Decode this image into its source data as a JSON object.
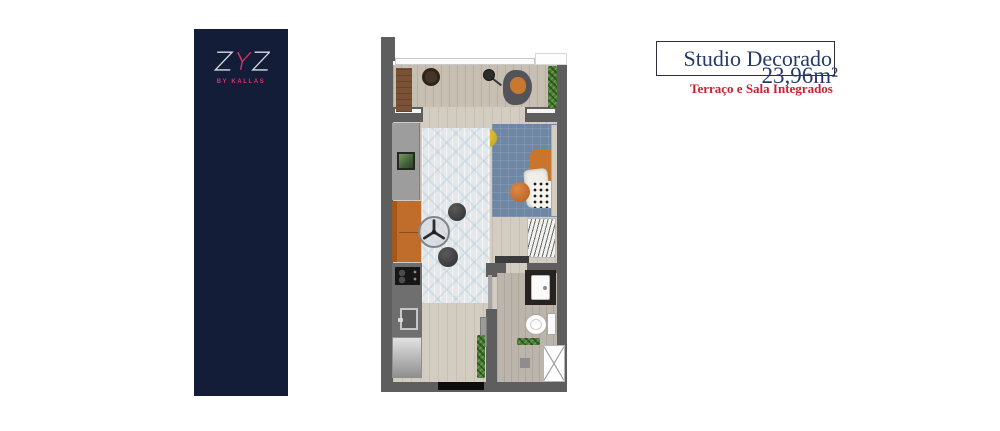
{
  "banner": {
    "logo_text": "ZYZ",
    "tagline": "BY KALLAS",
    "bg_color": "#131d38",
    "accent_pink": "#d8336b",
    "letter_silver": "#d9dde6"
  },
  "header": {
    "title": "Studio Decorado",
    "area": "23,96m²",
    "subtitle": "Terraço e Sala Integrados",
    "title_color": "#26396a",
    "subtitle_color": "#cc2030"
  },
  "floor_plan": {
    "label": "studio-floor-plan",
    "furniture_icons": [
      "terrace-rug-icon",
      "terrace-coffee-table-icon",
      "floor-lamp-icon",
      "terrace-armchair-icon",
      "planter-icon",
      "bed-icon",
      "bed-pillows-icon",
      "yellow-pouf-icon",
      "area-rug-icon",
      "tv-console-icon",
      "tv-icon",
      "sofa-icon",
      "round-dining-table-icon",
      "stool-icon",
      "stool-icon",
      "kitchen-counter-icon",
      "cooktop-icon",
      "kitchen-sink-icon",
      "refrigerator-icon",
      "wardrobe-icon",
      "dresser-icon",
      "bathroom-vanity-icon",
      "toilet-icon",
      "plant-shelf-icon",
      "shower-box-icon",
      "hall-planter-icon",
      "entry-mat-icon",
      "sliding-door-icon",
      "entry-door-icon"
    ]
  }
}
